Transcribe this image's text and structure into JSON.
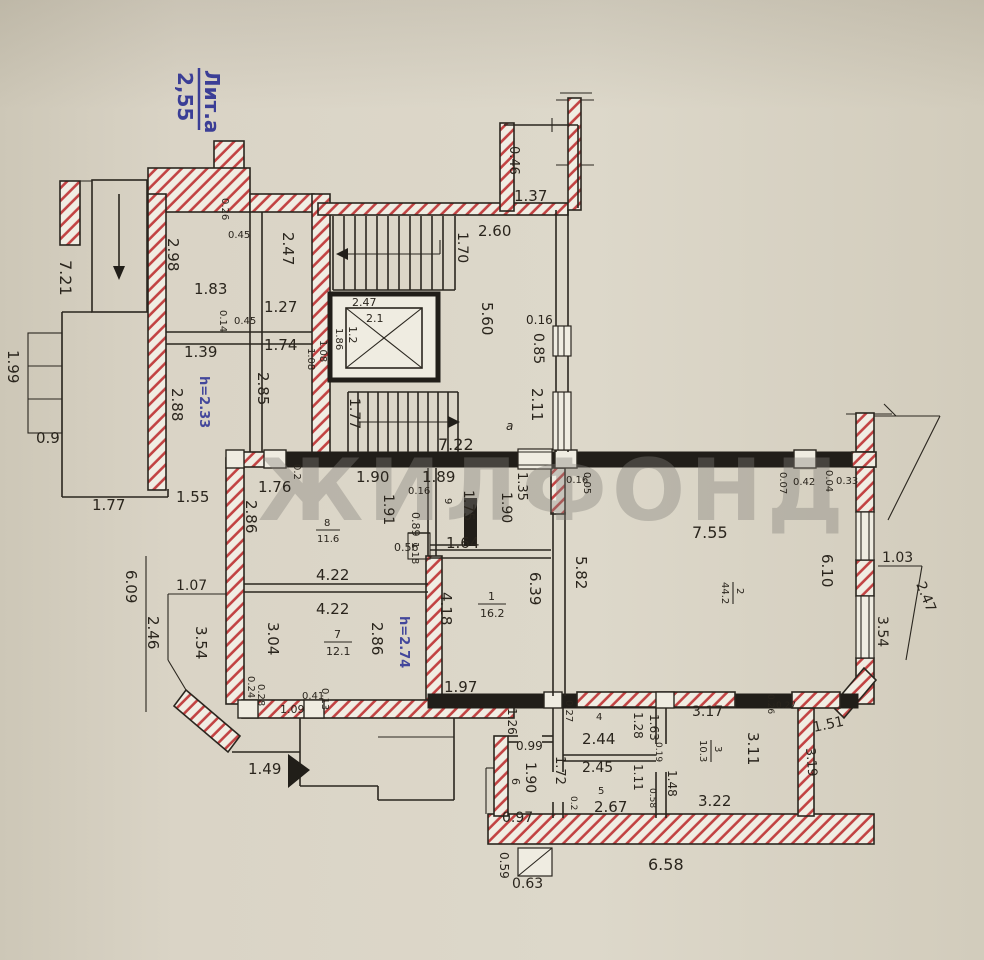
{
  "plan": {
    "liter": {
      "label": "Лит.а",
      "value": "2,55"
    },
    "watermark": "ЖИЛФОНД",
    "heights": {
      "h233": "h=2.33",
      "h274": "h=2.74"
    },
    "rooms": {
      "r1": {
        "num": "1",
        "area": "16.2"
      },
      "r2": {
        "num": "2",
        "area": "44.2"
      },
      "r3": {
        "num": "3",
        "area": "10.3"
      },
      "r7": {
        "num": "7",
        "area": "12.1"
      },
      "r8": {
        "num": "8",
        "area": "11.6"
      },
      "r4": "4",
      "r5": "5",
      "r6": "6",
      "r9": "9",
      "ra": "а"
    },
    "dims": {
      "left": [
        "7.21",
        "1.99",
        "0.9",
        "1.77",
        "1.55",
        "1.07",
        "6.09",
        "2.46",
        "3.54",
        "1.49"
      ],
      "nw": [
        "2.98",
        "1.83",
        "0.26",
        "0.45",
        "2.47",
        "1.27",
        "0.14",
        "0.45",
        "1.39",
        "1.74",
        "1.08",
        "2.85",
        "2.88",
        "1.76"
      ],
      "stair": [
        "1.70",
        "2.60",
        "2.47",
        "2.1",
        "1.2",
        "1.86",
        "1.08",
        "1.77",
        "7.22",
        "5.60",
        "0.16",
        "0.85",
        "2.11",
        "0.46",
        "1.37"
      ],
      "corridor": [
        "1.90",
        "1.89",
        "0.2",
        "1.35",
        "1.90",
        "0.16",
        "0.05",
        "0.07",
        "0.42",
        "0.04",
        "0.33"
      ],
      "entry": [
        "1.91",
        "0.16",
        "1.75",
        "0.89",
        "0.56",
        "1.18",
        "1.64"
      ],
      "mid": [
        "2.86",
        "4.22",
        "4.22",
        "3.04",
        "2.86",
        "4.18",
        "1.97",
        "0.24",
        "0.28",
        "1.09",
        "0.41",
        "0.13"
      ],
      "room1": [
        "6.39",
        "1.26",
        "0.99"
      ],
      "room2": [
        "7.55",
        "5.82",
        "6.10"
      ],
      "right": [
        "1.03",
        "2.47",
        "3.54",
        "1.51",
        "3.19"
      ],
      "south": [
        "3.17",
        "2.44",
        "2.45",
        "2.67",
        "3.22",
        "3.11",
        "1.63",
        "1.28",
        "1.11",
        "1.48",
        "1.72",
        "0.19",
        "0.58",
        "0.27",
        "0.26",
        "0.27",
        "0.2"
      ],
      "room6": [
        "1.90",
        "0.97"
      ],
      "bottom": [
        "6.58",
        "0.59",
        "0.63"
      ]
    }
  }
}
